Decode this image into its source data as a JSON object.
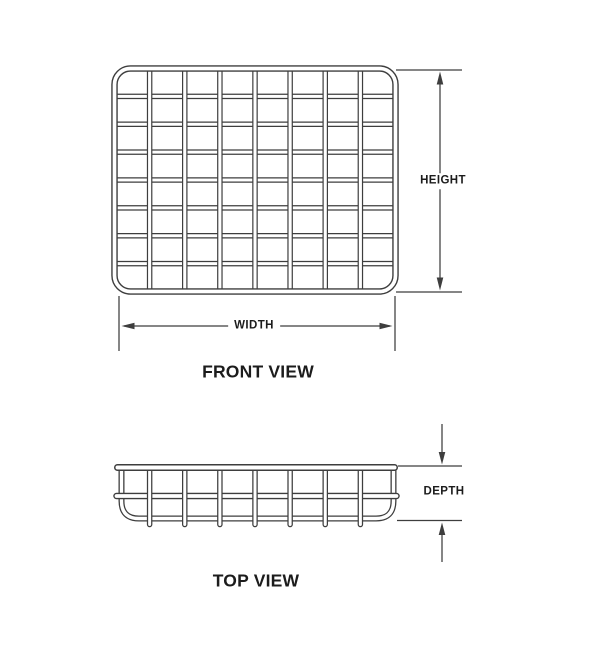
{
  "diagram": {
    "title_semantic": "wire-grid-basket-dimension-diagram",
    "front_view": {
      "label": "FRONT VIEW",
      "grid_columns": 8,
      "grid_rows": 8,
      "height_label": "HEIGHT",
      "width_label": "WIDTH"
    },
    "top_view": {
      "label": "TOP VIEW",
      "grid_columns": 8,
      "depth_label": "DEPTH"
    },
    "colors": {
      "line": "#3e3e3e",
      "text": "#1c1c1c",
      "background": "#ffffff"
    }
  }
}
